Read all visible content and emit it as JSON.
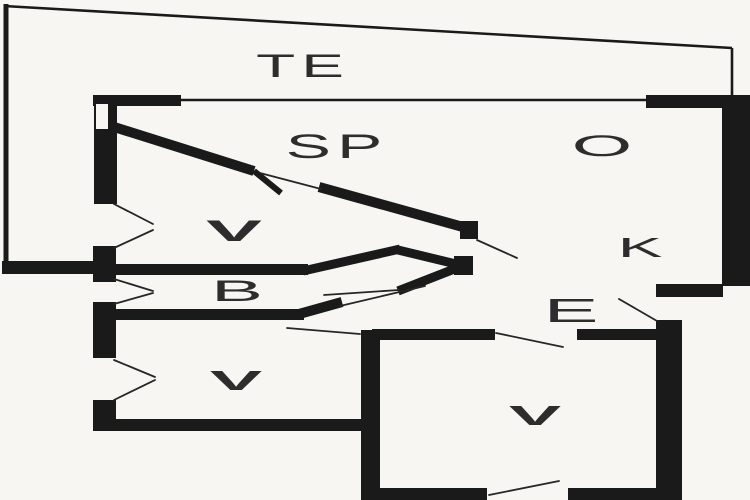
{
  "colors": {
    "bg": "#f7f6f2",
    "ink": "#1a1a1a",
    "label": "#2d2d2d"
  },
  "labels": {
    "terrace": "TE",
    "sp_room": "SP",
    "o_room": "O",
    "k_room": "K",
    "b_room": "B",
    "e_hall": "E",
    "v_mark": "V"
  }
}
